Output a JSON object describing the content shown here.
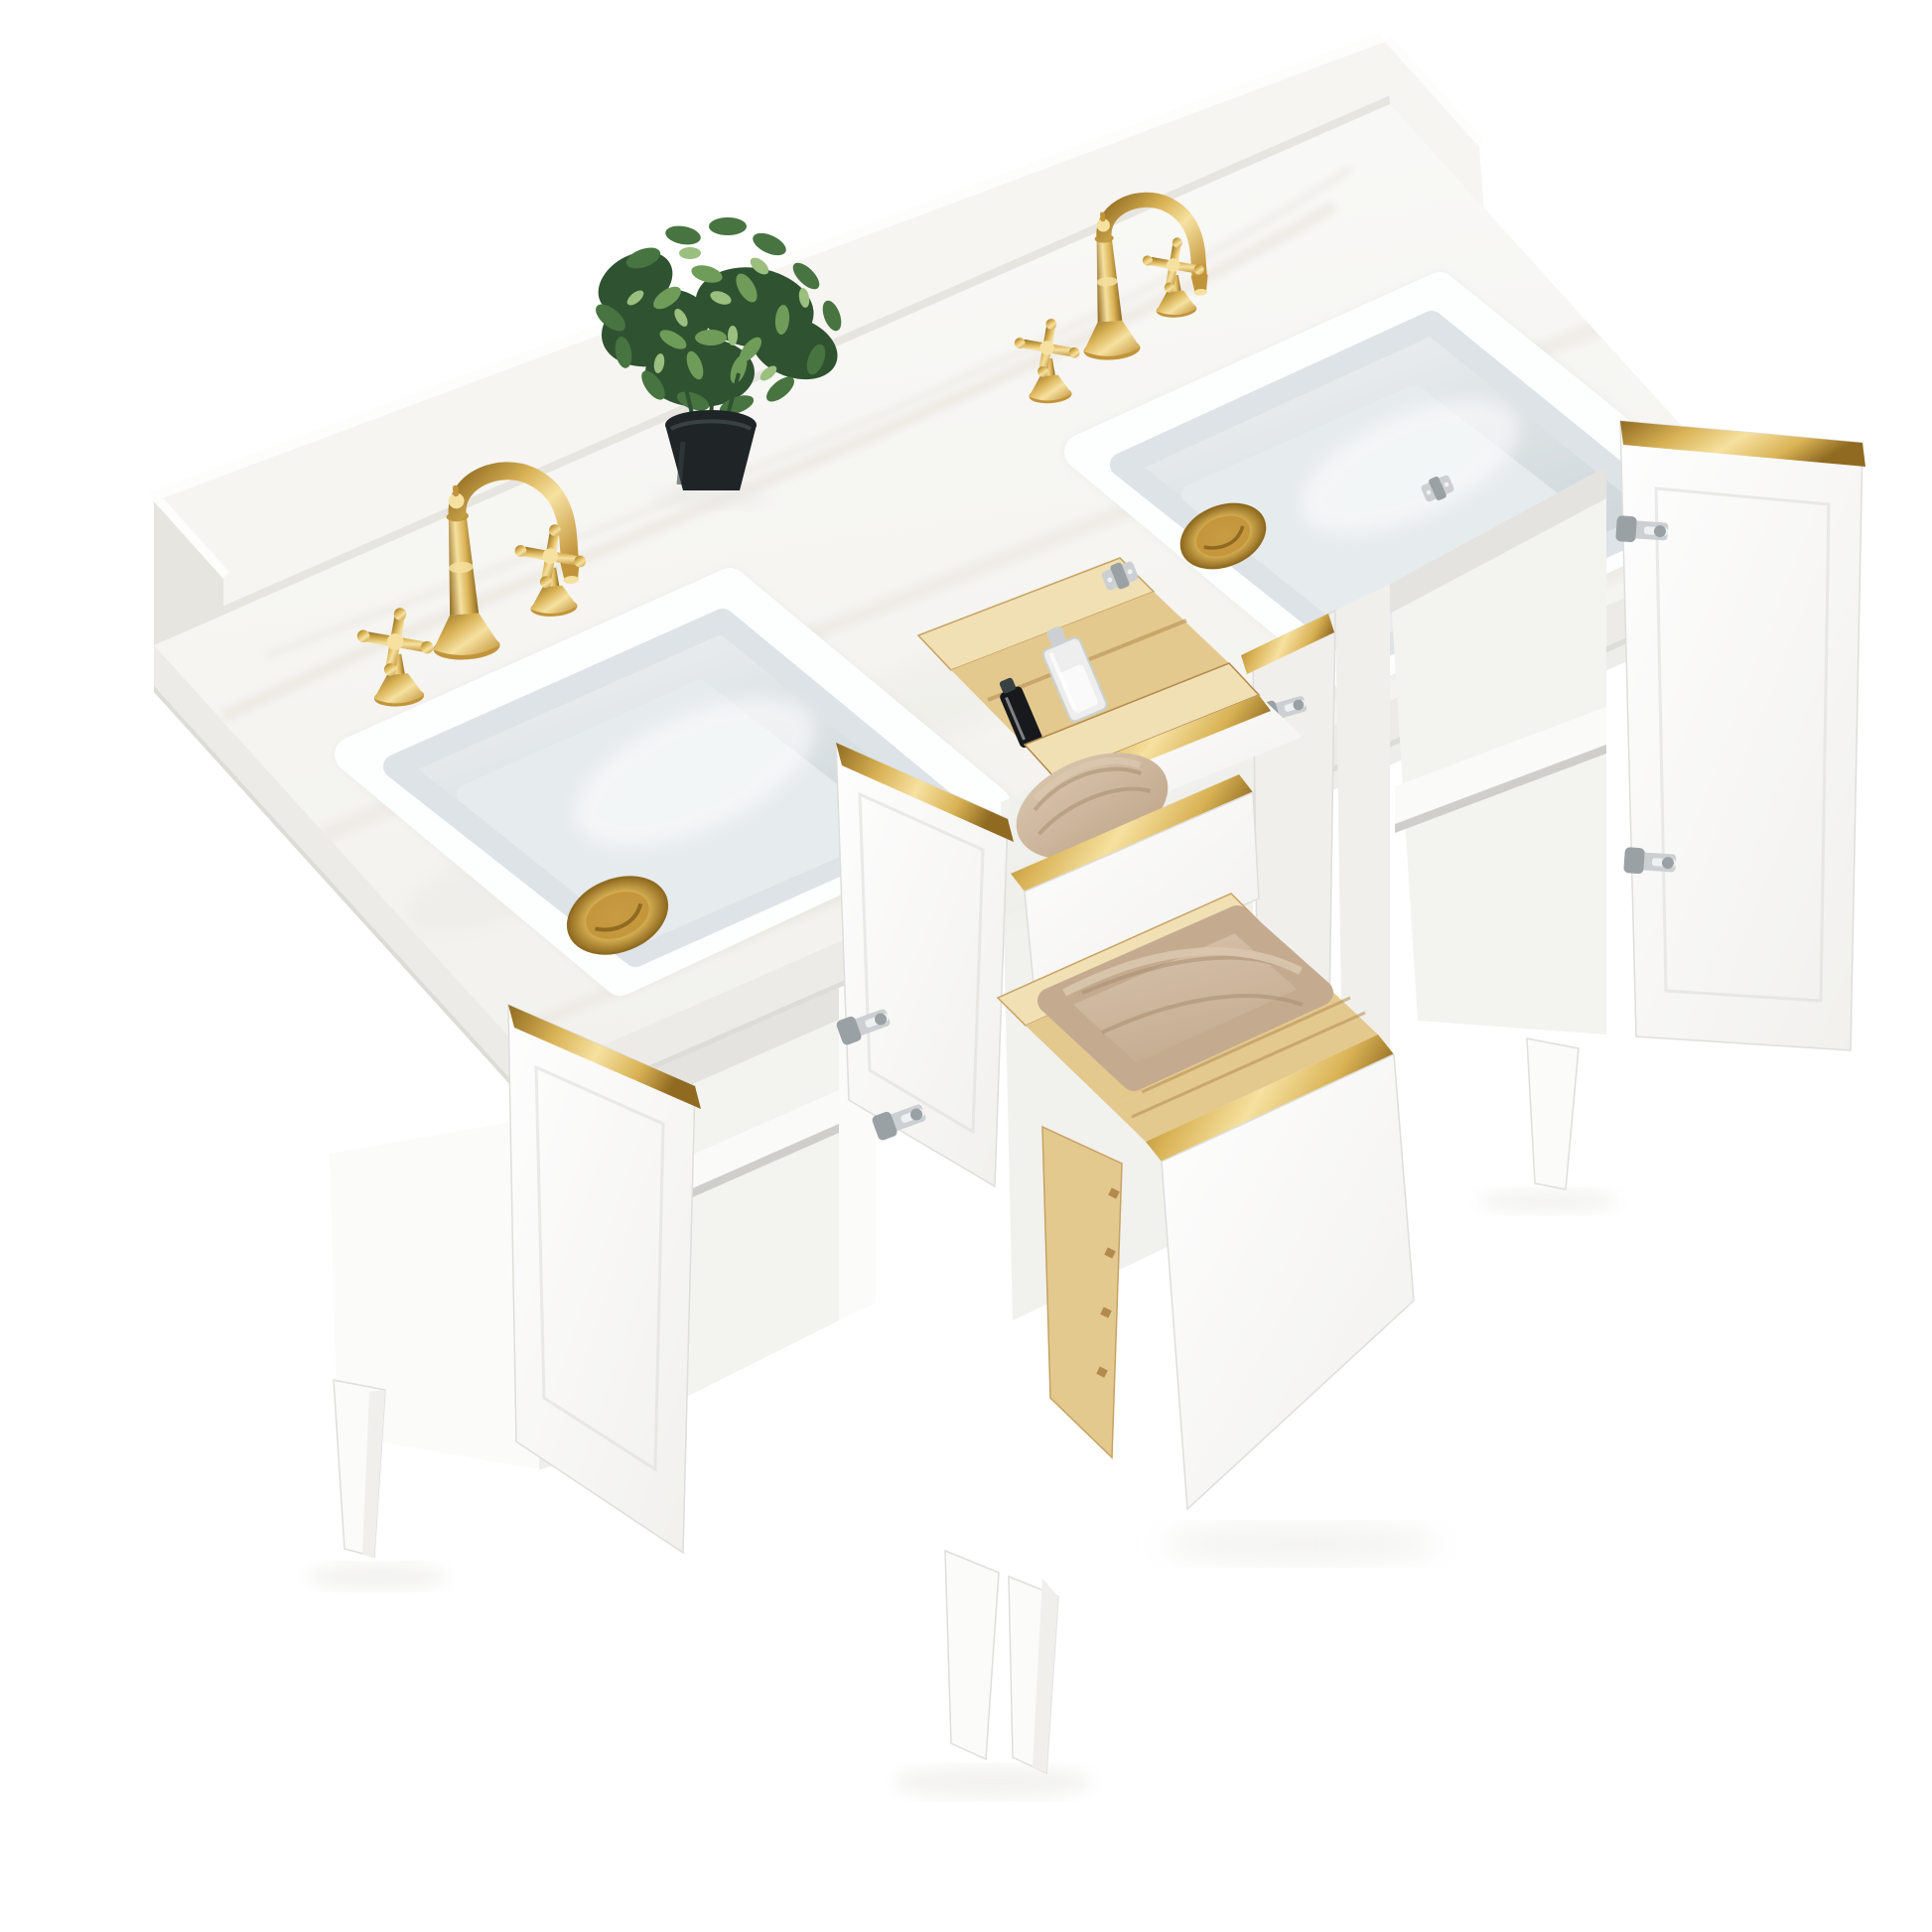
{
  "image": {
    "type": "product-photo",
    "subject": "White double-sink bathroom vanity, three-quarter aerial view, with marble top, brushed gold faucets and trim, open doors and drawers with towels and accessories",
    "background": "#ffffff"
  },
  "colors": {
    "bg": "#ffffff",
    "marbleTop": "#f2f1ed",
    "marbleTopLight": "#fafaf8",
    "vein": "#e3ddd2",
    "counterEdge": "#ecebe7",
    "counterEdgeShade": "#dddcd7",
    "splashFace": "#f6f5f2",
    "splashTop": "#fdfdfc",
    "splashShade": "#e7e5e0",
    "cabinetFace": "#fbfbfa",
    "cabinetShade": "#f0efec",
    "cabinetDark": "#dededa",
    "interior": "#f3f3f0",
    "interiorShade": "#e4e3df",
    "shelf": "#fafaf9",
    "crevice": "#cfcecb",
    "sinkRim": "#fdfefe",
    "bowlLight": "#f3f5f6",
    "bowlMid": "#dde3e6",
    "bowlDeep": "#c9d2d6",
    "bowlFloor": "#e6ebed",
    "doorLight": "#fefefe",
    "doorShade": "#f1f0ed",
    "goldLight": "#f6e1a0",
    "gold": "#d9b255",
    "goldMid": "#c2943a",
    "goldDark": "#8f6a20",
    "pineLight": "#f1e0b4",
    "pine": "#e4c98e",
    "pineDark": "#c7a263",
    "pineStreak": "#b28a4e",
    "towelLight": "#d9c6ae",
    "towel": "#c4ab90",
    "towelDark": "#a68a6e",
    "leafDark": "#2f5230",
    "leaf": "#477440",
    "leafLight": "#6f9c59",
    "leafPale": "#9bbf7f",
    "pot": "#1f2427",
    "potLight": "#394144",
    "nickel": "#ccd0d2",
    "nickelDark": "#9aa1a5",
    "nickelLight": "#eef1f2",
    "glass": "#eef1f3",
    "bottleDark": "#17191c",
    "shadow": "#e9e8e5"
  },
  "objects": [
    "marble countertop with backsplash",
    "two undermount rectangular sinks",
    "two brushed-gold widespread faucets with cross handles",
    "gold pop-up sink drains",
    "faux green plant in black pot",
    "open cabinet doors with brushed-gold edge trim",
    "tilt-out drawer with pine organizer, perfume and cosmetic bottles",
    "open drawers with beige towels",
    "nickel soft-close hinges",
    "white cabinet with tapered legs"
  ]
}
